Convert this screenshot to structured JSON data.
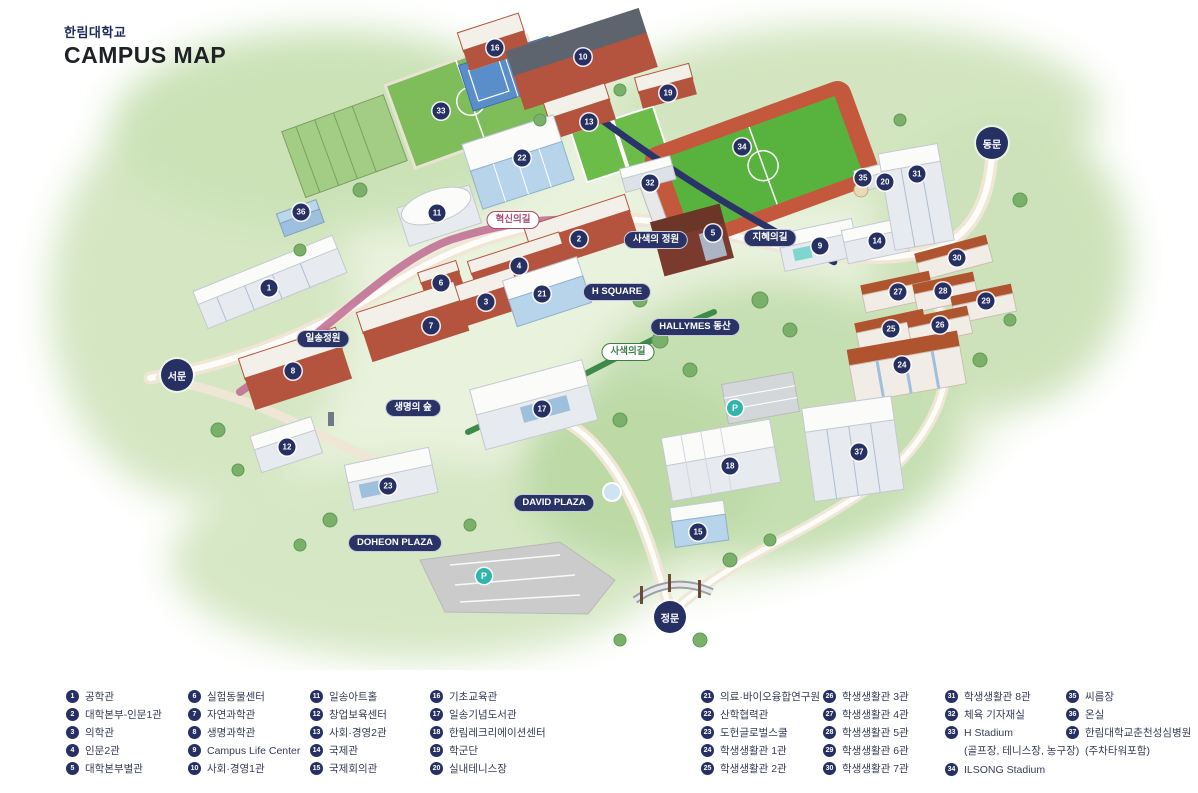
{
  "header": {
    "org": "한림대학교",
    "title": "CAMPUS MAP"
  },
  "colors": {
    "navy": "#263063",
    "pink": "#a84a72",
    "green": "#3c7d46",
    "teal": "#2fb5ac"
  },
  "map": {
    "gates": [
      {
        "label": "서문",
        "x": 177,
        "y": 375
      },
      {
        "label": "동문",
        "x": 992,
        "y": 143
      },
      {
        "label": "정문",
        "x": 670,
        "y": 617
      }
    ],
    "path_labels": [
      {
        "label": "혁신의길",
        "x": 513,
        "y": 220,
        "style": "pink"
      },
      {
        "label": "지혜의길",
        "x": 770,
        "y": 238,
        "style": "navy"
      },
      {
        "label": "사색의길",
        "x": 628,
        "y": 352,
        "style": "green"
      }
    ],
    "place_labels": [
      {
        "label": "사색의 정원",
        "x": 656,
        "y": 240
      },
      {
        "label": "H SQUARE",
        "x": 617,
        "y": 292
      },
      {
        "label": "HALLYMES 동산",
        "x": 695,
        "y": 327
      },
      {
        "label": "일송정원",
        "x": 323,
        "y": 339
      },
      {
        "label": "생명의 숲",
        "x": 413,
        "y": 408
      },
      {
        "label": "DAVID PLAZA",
        "x": 554,
        "y": 503
      },
      {
        "label": "DOHEON PLAZA",
        "x": 395,
        "y": 543
      }
    ],
    "parking": [
      {
        "label": "P",
        "x": 484,
        "y": 576
      },
      {
        "label": "P",
        "x": 735,
        "y": 408
      }
    ],
    "markers": [
      {
        "n": "1",
        "x": 269,
        "y": 288
      },
      {
        "n": "2",
        "x": 579,
        "y": 239
      },
      {
        "n": "3",
        "x": 486,
        "y": 302
      },
      {
        "n": "4",
        "x": 519,
        "y": 266
      },
      {
        "n": "5",
        "x": 713,
        "y": 233
      },
      {
        "n": "6",
        "x": 441,
        "y": 283
      },
      {
        "n": "7",
        "x": 431,
        "y": 326
      },
      {
        "n": "8",
        "x": 293,
        "y": 371
      },
      {
        "n": "9",
        "x": 820,
        "y": 246
      },
      {
        "n": "10",
        "x": 583,
        "y": 57
      },
      {
        "n": "11",
        "x": 437,
        "y": 213
      },
      {
        "n": "12",
        "x": 287,
        "y": 447
      },
      {
        "n": "13",
        "x": 589,
        "y": 122
      },
      {
        "n": "14",
        "x": 877,
        "y": 241
      },
      {
        "n": "15",
        "x": 698,
        "y": 532
      },
      {
        "n": "16",
        "x": 495,
        "y": 48
      },
      {
        "n": "17",
        "x": 542,
        "y": 409
      },
      {
        "n": "18",
        "x": 730,
        "y": 466
      },
      {
        "n": "19",
        "x": 668,
        "y": 93
      },
      {
        "n": "20",
        "x": 885,
        "y": 182
      },
      {
        "n": "21",
        "x": 542,
        "y": 294
      },
      {
        "n": "22",
        "x": 522,
        "y": 158
      },
      {
        "n": "23",
        "x": 388,
        "y": 486
      },
      {
        "n": "24",
        "x": 902,
        "y": 365
      },
      {
        "n": "25",
        "x": 891,
        "y": 329
      },
      {
        "n": "26",
        "x": 940,
        "y": 325
      },
      {
        "n": "27",
        "x": 898,
        "y": 292
      },
      {
        "n": "28",
        "x": 943,
        "y": 291
      },
      {
        "n": "29",
        "x": 986,
        "y": 301
      },
      {
        "n": "30",
        "x": 957,
        "y": 258
      },
      {
        "n": "31",
        "x": 917,
        "y": 174
      },
      {
        "n": "32",
        "x": 650,
        "y": 183
      },
      {
        "n": "33",
        "x": 441,
        "y": 111
      },
      {
        "n": "34",
        "x": 742,
        "y": 147
      },
      {
        "n": "35",
        "x": 863,
        "y": 178
      },
      {
        "n": "36",
        "x": 301,
        "y": 212
      },
      {
        "n": "37",
        "x": 859,
        "y": 452
      }
    ]
  },
  "legend": {
    "column_x": [
      66,
      188,
      310,
      430,
      701,
      823,
      945,
      1066
    ],
    "columns": [
      [
        {
          "num": "1",
          "label": "공학관"
        },
        {
          "num": "2",
          "label": "대학본부-인문1관"
        },
        {
          "num": "3",
          "label": "의학관"
        },
        {
          "num": "4",
          "label": "인문2관"
        },
        {
          "num": "5",
          "label": "대학본부별관"
        }
      ],
      [
        {
          "num": "6",
          "label": "실험동물센터"
        },
        {
          "num": "7",
          "label": "자연과학관"
        },
        {
          "num": "8",
          "label": "생명과학관"
        },
        {
          "num": "9",
          "label": "Campus Life Center"
        },
        {
          "num": "10",
          "label": "사회·경영1관"
        }
      ],
      [
        {
          "num": "11",
          "label": "일송아트홀"
        },
        {
          "num": "12",
          "label": "창업보육센터"
        },
        {
          "num": "13",
          "label": "사회·경영2관"
        },
        {
          "num": "14",
          "label": "국제관"
        },
        {
          "num": "15",
          "label": "국제회의관"
        }
      ],
      [
        {
          "num": "16",
          "label": "기초교육관"
        },
        {
          "num": "17",
          "label": "일송기념도서관"
        },
        {
          "num": "18",
          "label": "한림레크리에이션센터"
        },
        {
          "num": "19",
          "label": "학군단"
        },
        {
          "num": "20",
          "label": "실내테니스장"
        }
      ],
      [
        {
          "num": "21",
          "label": "의료·바이오융합연구원"
        },
        {
          "num": "22",
          "label": "산학협력관"
        },
        {
          "num": "23",
          "label": "도헌글로벌스쿨"
        },
        {
          "num": "24",
          "label": "학생생활관 1관"
        },
        {
          "num": "25",
          "label": "학생생활관 2관"
        }
      ],
      [
        {
          "num": "26",
          "label": "학생생활관 3관"
        },
        {
          "num": "27",
          "label": "학생생활관 4관"
        },
        {
          "num": "28",
          "label": "학생생활관 5관"
        },
        {
          "num": "29",
          "label": "학생생활관 6관"
        },
        {
          "num": "30",
          "label": "학생생활관 7관"
        }
      ],
      [
        {
          "num": "31",
          "label": "학생생활관 8관"
        },
        {
          "num": "32",
          "label": "체육 기자재실"
        },
        {
          "num": "33",
          "label": "H Stadium",
          "sub": "(골프장, 테니스장, 농구장)"
        },
        {
          "num": "34",
          "label": "ILSONG Stadium"
        }
      ],
      [
        {
          "num": "35",
          "label": "씨름장"
        },
        {
          "num": "36",
          "label": "온실"
        },
        {
          "num": "37",
          "label": "한림대학교춘천성심병원",
          "sub": "(주차타워포함)"
        }
      ]
    ]
  }
}
